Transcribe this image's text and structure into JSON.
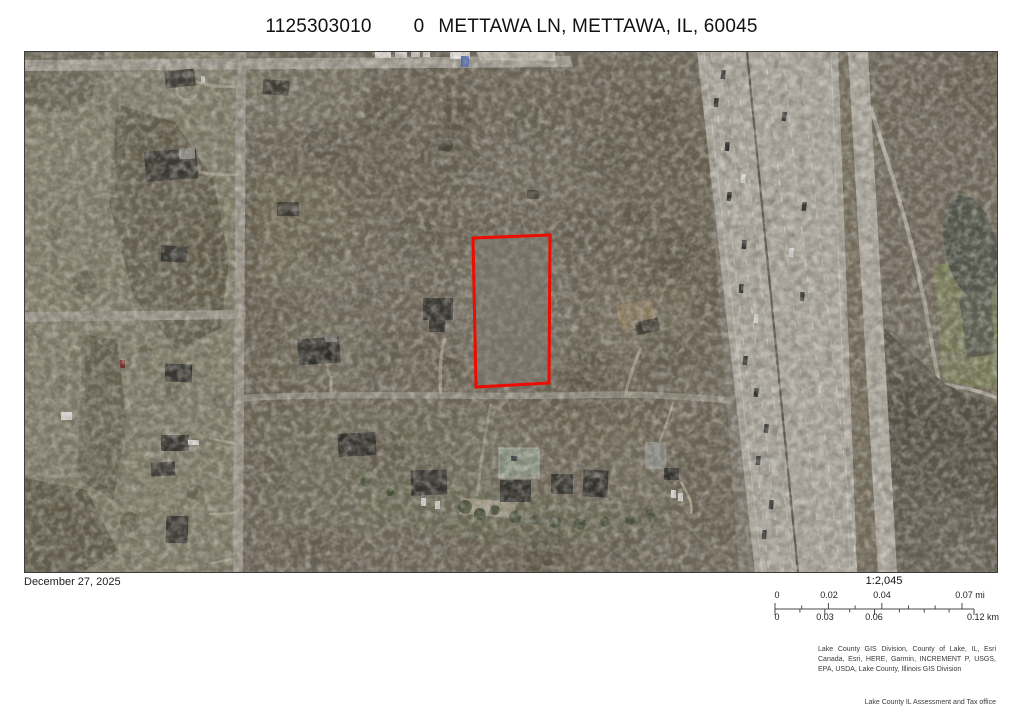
{
  "title": {
    "parcel_id": "1125303010",
    "house_number": "0",
    "address_rest": "METTAWA LN, METTAWA, IL, 60045"
  },
  "map": {
    "date": "December 27, 2025",
    "parcel_outline_color": "#ee0b00",
    "imagery_description": "aerial-photo-mettawa-parcel"
  },
  "scalebar": {
    "ratio": "1:2,045",
    "mi": {
      "t0": "0",
      "t1": "0.02",
      "t2": "0.04",
      "t3": "0.07 mi"
    },
    "km": {
      "t0": "0",
      "t1": "0.03",
      "t2": "0.06",
      "t3": "0.12 km"
    }
  },
  "attribution": {
    "line1": "Lake County GIS Division, County of Lake, IL, Esri",
    "line2": "Canada, Esri, HERE, Garmin, INCREMENT P, USGS,",
    "line3": "EPA, USDA, Lake County, Illinois GIS Division"
  },
  "credit": "Lake County IL Assessment and Tax office"
}
